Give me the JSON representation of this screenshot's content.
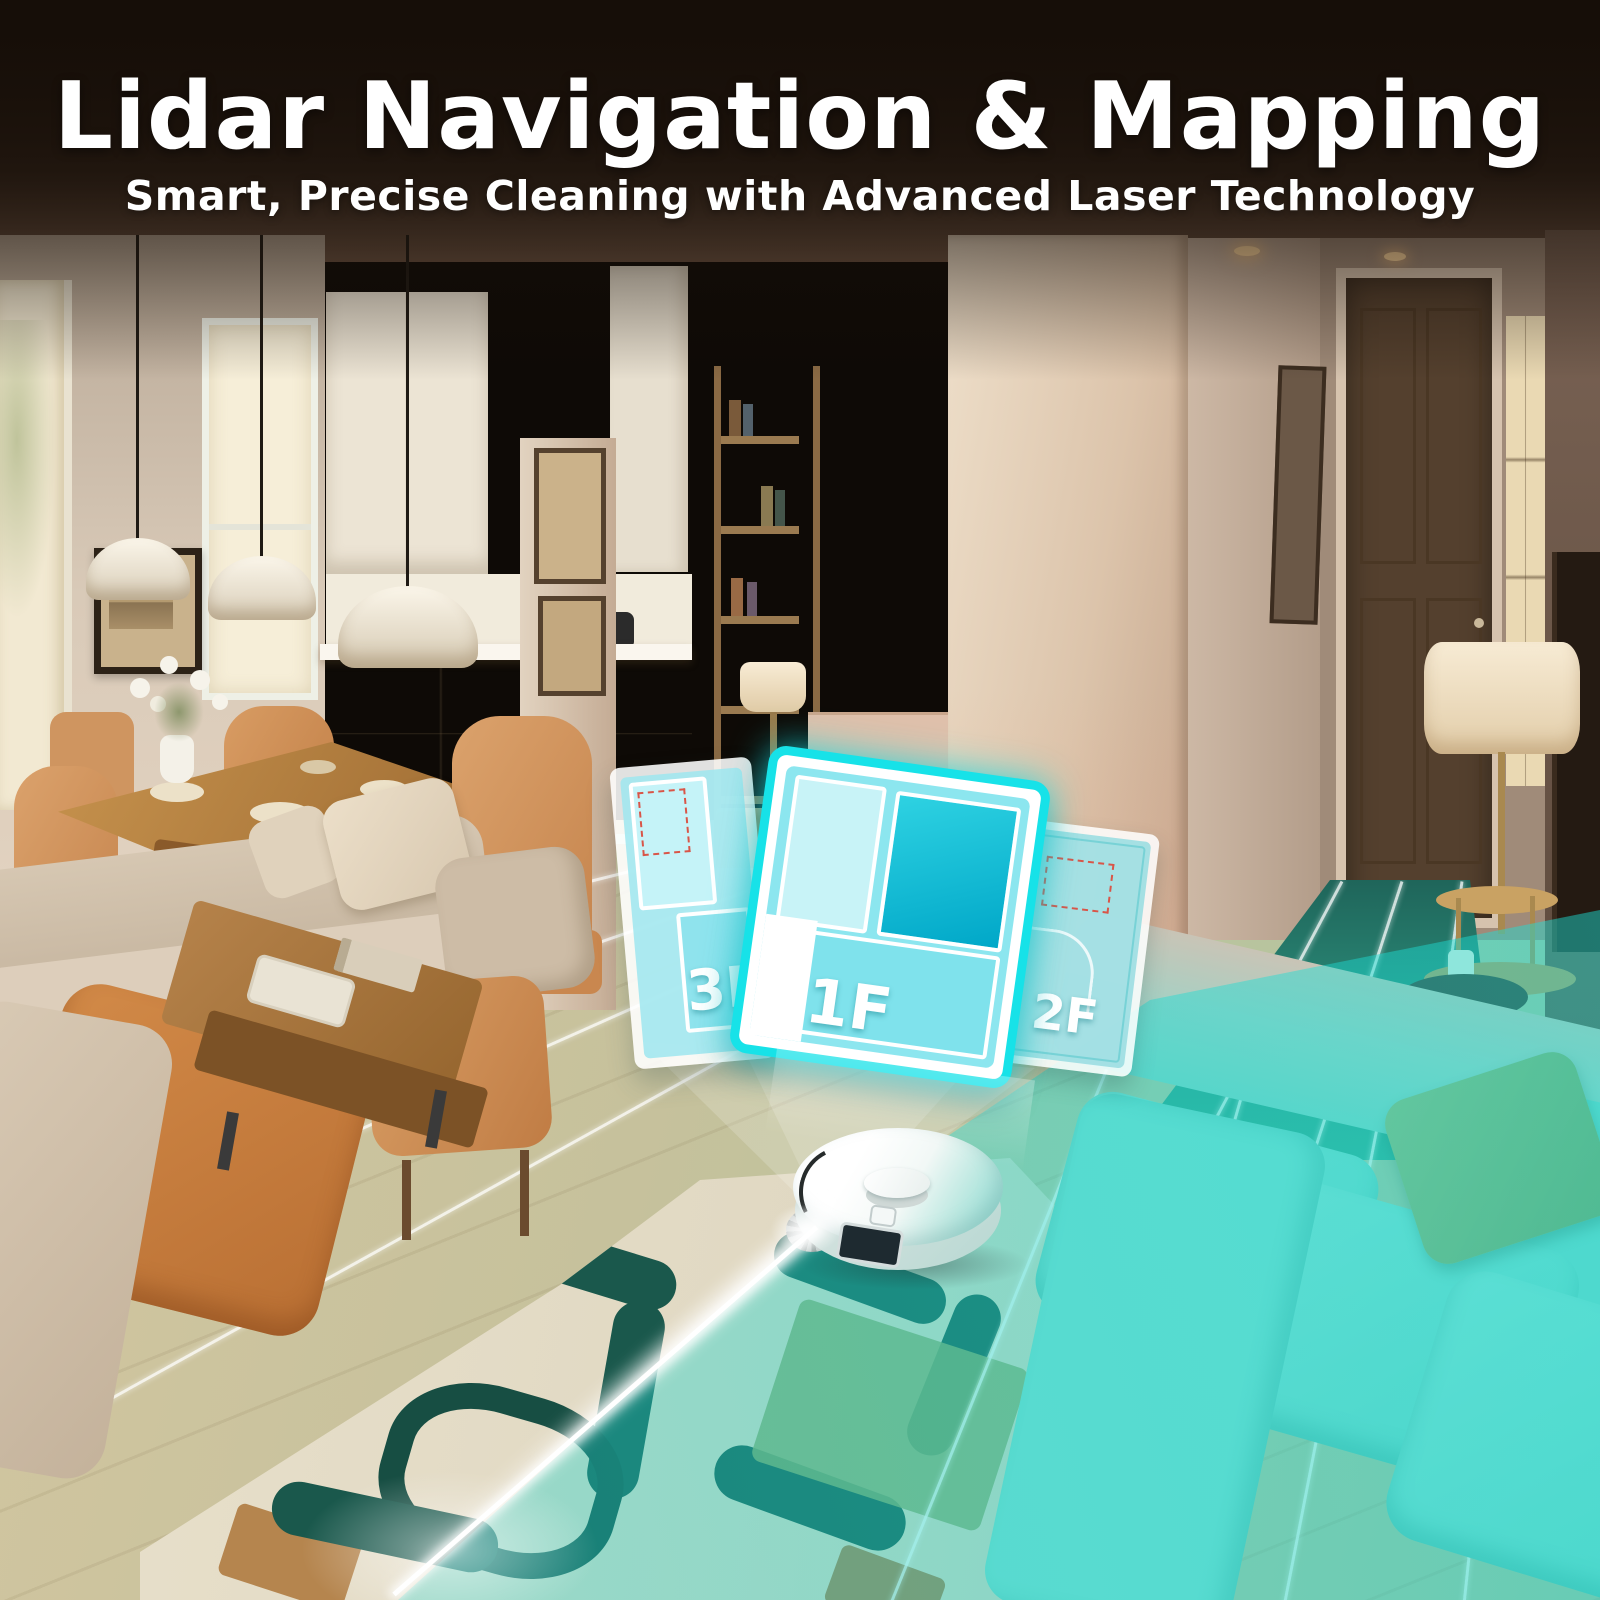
{
  "header": {
    "title": "Lidar Navigation & Mapping",
    "subtitle": "Smart, Precise Cleaning with Advanced Laser Technology"
  },
  "floor_maps": {
    "active": "1F",
    "cards": [
      {
        "label": "3F"
      },
      {
        "label": "1F"
      },
      {
        "label": "2F"
      }
    ]
  },
  "colors": {
    "accent_cyan": "#17e2e8",
    "map_fill": "#8ce6ef",
    "map_room_light": "#c8f3f7",
    "map_room_dark": "#00a7c8",
    "no_go_red": "#d95548",
    "laser_white": "#ffffff",
    "scan_tint": "#1cd8d0"
  }
}
